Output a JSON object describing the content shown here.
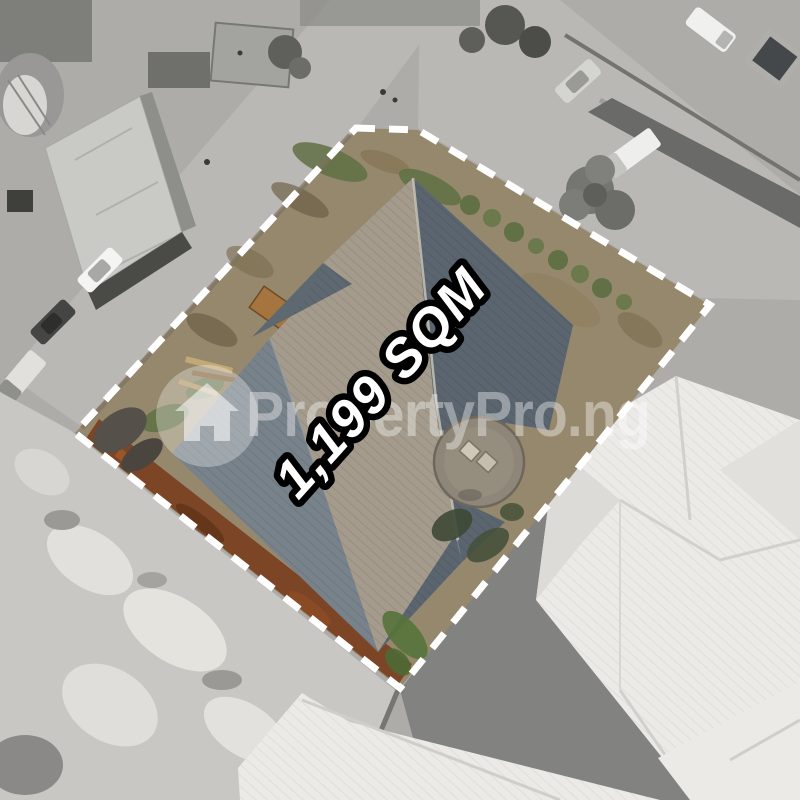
{
  "image": {
    "type": "aerial-drone-listing-photo",
    "area_label": "1,199 SQM",
    "watermark": {
      "logo": "house-in-circle-icon",
      "text": "PropertyPro.ng"
    }
  },
  "colors": {
    "boundary_dash": "#ffffff",
    "area_label_fill": "#ffffff",
    "area_label_outline": "#000000",
    "watermark_fill": "rgba(255,255,255,0.38)",
    "watermark_logo_fill": "rgba(255,255,255,0.30)",
    "watermark_house_fill": "rgba(255,255,255,0.55)",
    "surround_gray": "#aeaca8",
    "road_gray": "#bab8b4",
    "sand_gray": "#c9c7c3",
    "white_roof": "#eceae7",
    "plot_dirt": "#96886c",
    "rust_dirt": "#7b4526",
    "grass_green": "#5f7044",
    "roof_silhouette": "#78828a",
    "roof_dark_face": "#5a656f",
    "roof_light_face": "#a49b8c",
    "dome_concrete": "#8e8678"
  }
}
